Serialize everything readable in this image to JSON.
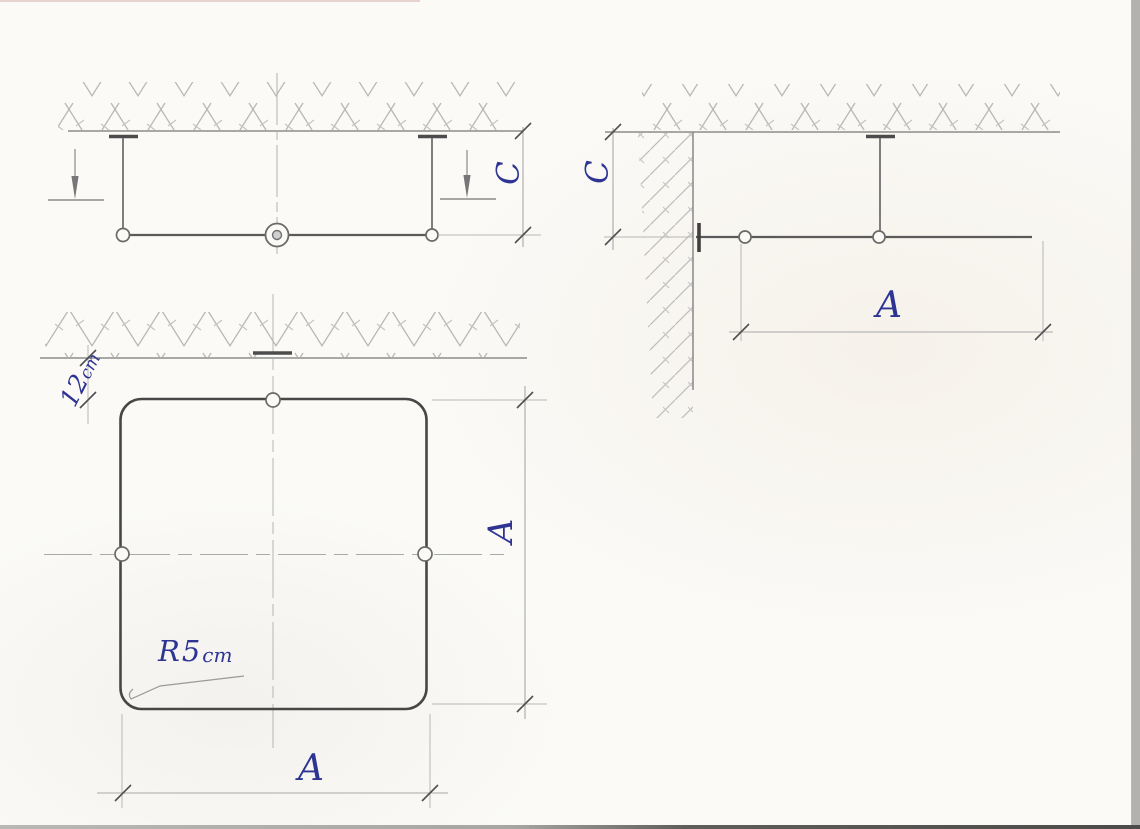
{
  "document": {
    "kind": "hand-drawn technical sketch",
    "paper_color": "#fbfaf7",
    "pencil_color": "#6a6a6a",
    "ink_color": "#2e3492"
  },
  "views": {
    "front_elevation": {
      "height_label": "C"
    },
    "corner_elevation": {
      "height_label": "C",
      "width_label": "A"
    },
    "plan": {
      "offset_value": "12",
      "offset_unit": "cm",
      "radius_letter": "R",
      "radius_value": "5",
      "radius_unit": "cm",
      "width_label": "A",
      "height_label": "A"
    }
  }
}
